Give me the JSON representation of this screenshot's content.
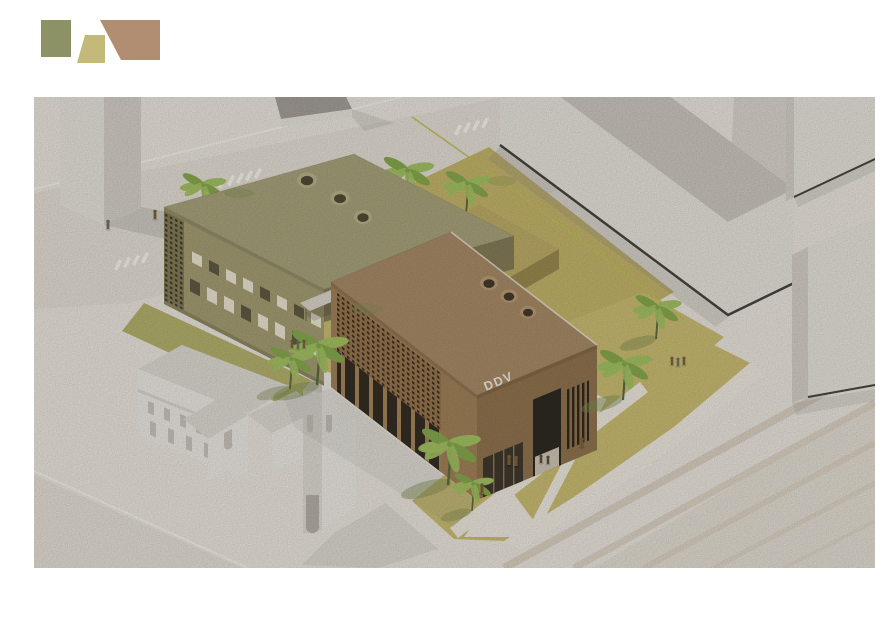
{
  "scene": {
    "ddv_label": "DDV",
    "description": "Isometric architectural rendering of the DDV project: two perforated-facade volumes (olive and brown) with round roof skylights on a palm-lined tan plaza, next to a white church and white context buildings, with wide steps at the lower right"
  },
  "logo": {
    "shapes": [
      "olive-square",
      "khaki-trapezoid",
      "brown-parallelogram"
    ]
  },
  "palette": {
    "ground": "#e9e4dc",
    "road": "#e2dcd3",
    "path": "#ece7dd",
    "cross": "#f6f3ec",
    "curb": "#f3efe8",
    "lane": "#bcbf55",
    "white-bright": "#e5e1da",
    "white-mid": "#d3cec6",
    "white-roof": "#cac5bd",
    "white-back": "#d8d3cb",
    "plinth": "#46443f",
    "shadow": "#8b8a88",
    "olive-wall": "#a39c72",
    "olive-dark": "#837c58",
    "olive-roof": "#a7a17a",
    "khaki-roof": "#bcab66",
    "khaki-wall": "#9a894f",
    "khaki-dark": "#a6954f",
    "brown-roof": "#a78a66",
    "brown-wall": "#a08159",
    "brown-dark": "#8f734e",
    "arcade": "#342d23",
    "pillar": "#a5855c",
    "opening": "#2e2a23",
    "glass": "#3f382c",
    "window-light": "#e9e3cf",
    "window-dark": "#5f5a42",
    "sky-rim-olive": "#b7b189",
    "sky-hole-olive": "#514b36",
    "sky-rim-brown": "#b99c74",
    "sky-hole-brown": "#46392a",
    "sky-rim-khaki": "#cdbd80",
    "sky-hole-khaki": "#564e30",
    "perf-dot-olive": "#3f3a28",
    "perf-dot-brown": "#3a2d1d",
    "perf-base-brown": "#97764f",
    "louver": "#2f281f",
    "tan1": "#c9bb72",
    "tan2": "#c2b36a",
    "grass": "#b3b06c",
    "steps-dark": "#d7cdbd",
    "church-bright": "#eae7e1",
    "church-mid": "#dcd8d1",
    "church-dark": "#c8c3bb",
    "portal": "#b5afa5",
    "tree": "#a2c162",
    "tree-dark": "#86a84d",
    "trunk": "#5c6b3c",
    "tree-shadow": "#7f8d52",
    "people": "#7d6138",
    "people-alt": "#6f6f6f",
    "canopy": "#d9d4ca",
    "ddv-text": "#f0eadf",
    "logo-olive": "#8d9266",
    "logo-khaki": "#c3ba7a",
    "logo-brown": "#b18e72"
  }
}
